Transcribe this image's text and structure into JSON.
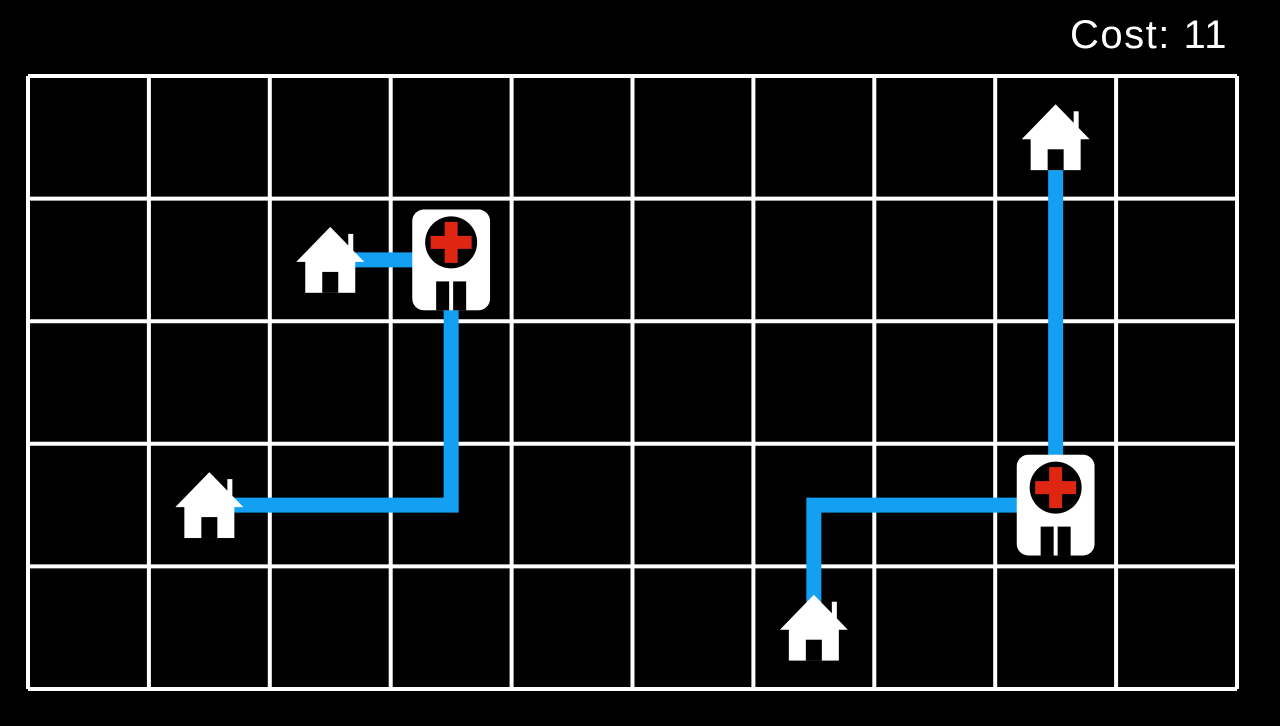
{
  "hud": {
    "cost_label": "Cost: 11",
    "cost_value": 11
  },
  "colors": {
    "background": "#000000",
    "grid_line": "#ffffff",
    "route": "#14A0F2",
    "icon": "#ffffff",
    "cross_red": "#DE2612",
    "door": "#000000"
  },
  "board": {
    "cols": 10,
    "rows": 5,
    "entities": [
      {
        "id": "hospital-a",
        "type": "hospital",
        "cell": [
          3,
          1
        ]
      },
      {
        "id": "hospital-b",
        "type": "hospital",
        "cell": [
          8,
          3
        ]
      },
      {
        "id": "house-a",
        "type": "house",
        "cell": [
          2,
          1
        ]
      },
      {
        "id": "house-b",
        "type": "house",
        "cell": [
          1,
          3
        ]
      },
      {
        "id": "house-c",
        "type": "house",
        "cell": [
          6,
          4
        ]
      },
      {
        "id": "house-d",
        "type": "house",
        "cell": [
          8,
          0
        ]
      }
    ],
    "routes": [
      {
        "from": "house-a",
        "to": "hospital-a",
        "waypoints": [
          [
            2,
            1
          ],
          [
            3,
            1
          ]
        ]
      },
      {
        "from": "house-b",
        "to": "hospital-a",
        "waypoints": [
          [
            1,
            3
          ],
          [
            3,
            3
          ],
          [
            3,
            1
          ]
        ]
      },
      {
        "from": "house-c",
        "to": "hospital-b",
        "waypoints": [
          [
            6,
            4
          ],
          [
            6,
            3
          ],
          [
            8,
            3
          ]
        ]
      },
      {
        "from": "house-d",
        "to": "hospital-b",
        "waypoints": [
          [
            8,
            0
          ],
          [
            8,
            3
          ]
        ]
      }
    ]
  }
}
